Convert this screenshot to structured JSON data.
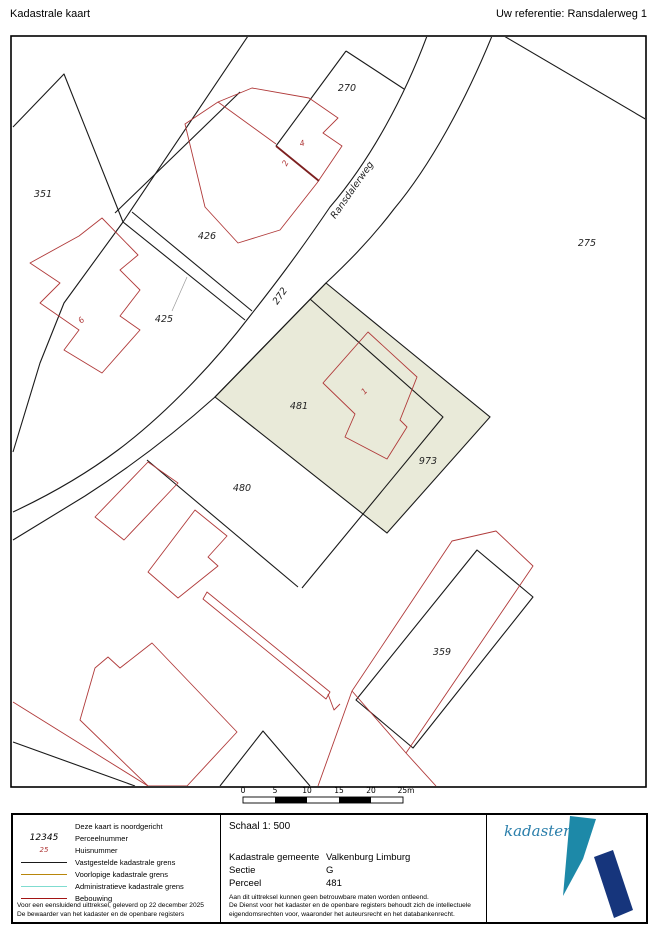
{
  "header": {
    "title": "Kadastrale kaart",
    "reference": "Uw referentie: Ransdalerweg 1"
  },
  "map": {
    "street_label": "Ransdalerweg",
    "labels": {
      "p270": "270",
      "p351": "351",
      "p426": "426",
      "p425": "425",
      "p272": "272",
      "p275": "275",
      "p481": "481",
      "p973": "973",
      "p480": "480",
      "p359": "359"
    },
    "house_numbers": {
      "h4": "4",
      "h2": "2",
      "h6": "6",
      "h1": "1"
    }
  },
  "scale_bar": {
    "ticks": [
      "0",
      "5",
      "10",
      "15",
      "20",
      "25m"
    ]
  },
  "legend": {
    "rows": [
      {
        "sample": "",
        "label": "Deze kaart is noordgericht",
        "color": ""
      },
      {
        "sample": "12345",
        "label": "Perceelnummer",
        "color": ""
      },
      {
        "sample": "25",
        "label": "Huisnummer",
        "color": ""
      },
      {
        "sample": "",
        "label": "Vastgestelde kadastrale grens",
        "color": "#1a1a1a"
      },
      {
        "sample": "",
        "label": "Voorlopige kadastrale grens",
        "color": "#b8860b"
      },
      {
        "sample": "",
        "label": "Administratieve kadastrale grens",
        "color": "#7fdcd0"
      },
      {
        "sample": "",
        "label": "Bebouwing",
        "color": "#a21414"
      }
    ],
    "footnote_left_1": "Voor een eensluidend uittreksel, geleverd op 22 december 2025",
    "footnote_left_2": "De bewaarder van het kadaster en de openbare registers"
  },
  "details": {
    "schaal": "Schaal 1: 500",
    "rows": [
      {
        "label": "Kadastrale gemeente",
        "value": "Valkenburg Limburg"
      },
      {
        "label": "Sectie",
        "value": "G"
      },
      {
        "label": "Perceel",
        "value": "481"
      }
    ],
    "footnote_1": "Aan dit uittreksel kunnen geen betrouwbare maten worden ontleend.",
    "footnote_2": "De Dienst voor het kadaster en de openbare registers behoudt zich de intellectuele",
    "footnote_3": "eigendomsrechten voor, waaronder het auteursrecht en het databankenrecht."
  },
  "logo": {
    "text": "kadaster"
  },
  "colors": {
    "highlight_parcel": "#e9ead9",
    "boundary": "#1a1a1a",
    "building": "#b03a3a",
    "provisional_boundary": "#b8860b",
    "administrative_boundary": "#7fdcd0",
    "bebouwing_legend": "#a21414",
    "logo_text": "#2b7fab",
    "logo_teal": "#1d89a8",
    "logo_navy": "#16357c"
  }
}
